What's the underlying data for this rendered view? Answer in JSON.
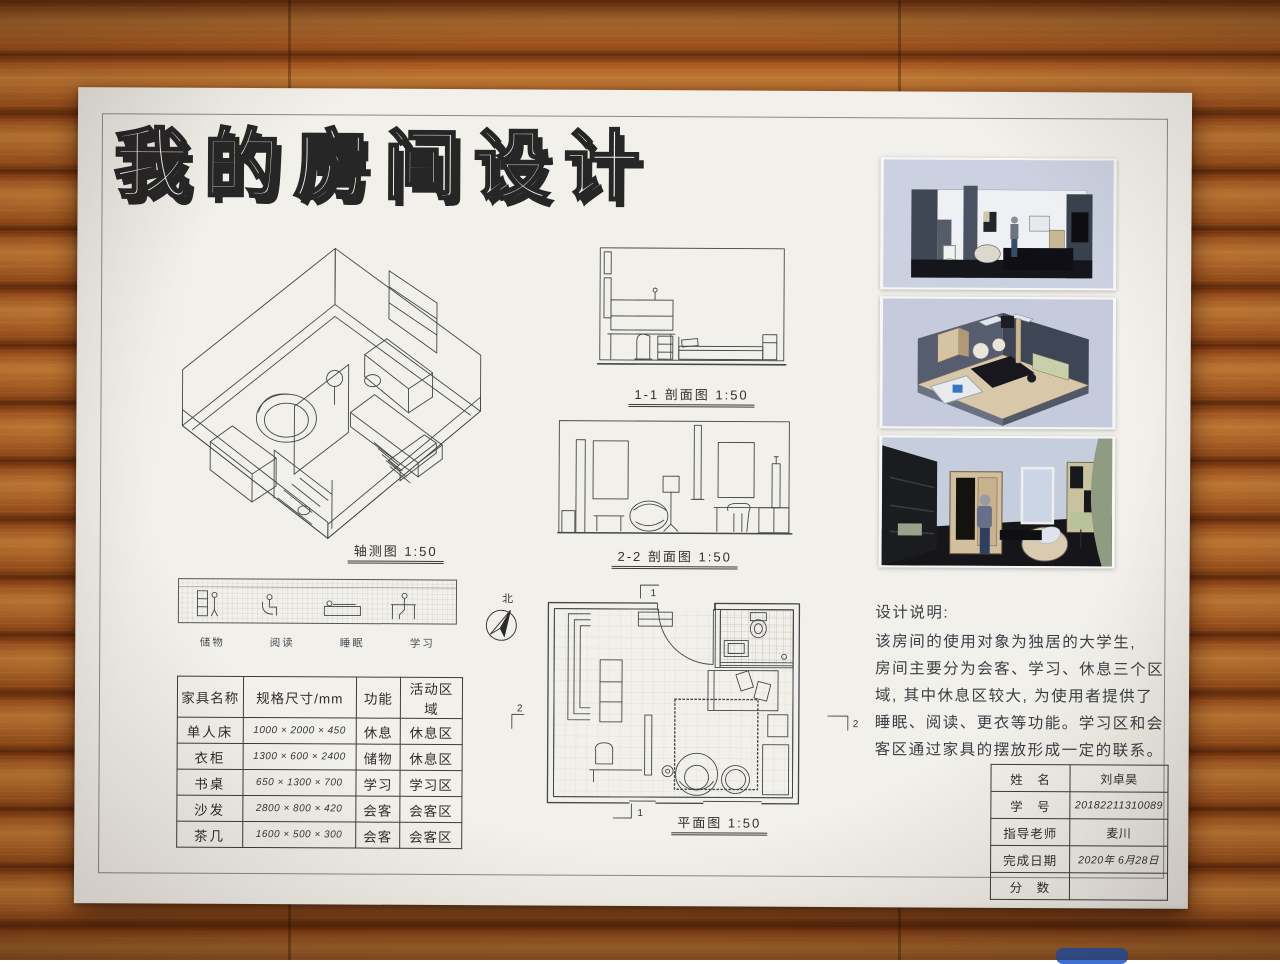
{
  "poster": {
    "title": "我的房间设计",
    "drawings": {
      "axon_caption": "轴测图 1:50",
      "section1_caption": "1-1 剖面图 1:50",
      "section2_caption": "2-2 剖面图 1:50",
      "plan_caption": "平面图 1:50",
      "north_label": "北",
      "marker_1": "1",
      "marker_2": "2",
      "strip_labels": [
        "储物",
        "阅读",
        "睡眠",
        "学习"
      ]
    },
    "furniture_table": {
      "headers": [
        "家具名称",
        "规格尺寸/mm",
        "功能",
        "活动区域"
      ],
      "rows": [
        [
          "单人床",
          "1000 × 2000 × 450",
          "休息",
          "休息区"
        ],
        [
          "衣柜",
          "1300 × 600 × 2400",
          "储物",
          "休息区"
        ],
        [
          "书桌",
          "650 × 1300 × 700",
          "学习",
          "学习区"
        ],
        [
          "沙发",
          "2800 × 800 × 420",
          "会客",
          "会客区"
        ],
        [
          "茶几",
          "1600 × 500 × 300",
          "会客",
          "会客区"
        ]
      ]
    },
    "description": {
      "heading": "设计说明:",
      "lines": [
        "该房间的使用对象为独居的大学生,",
        "房间主要分为会客、学习、休息三个区",
        "域, 其中休息区较大, 为使用者提供了",
        "睡眠、阅读、更衣等功能。学习区和会",
        "客区通过家具的摆放形成一定的联系。"
      ]
    },
    "title_block": {
      "rows": [
        {
          "label": "姓　名",
          "value": "刘卓昊"
        },
        {
          "label": "学　号",
          "value": "20182211310089"
        },
        {
          "label": "指导老师",
          "value": "麦川"
        },
        {
          "label": "完成日期",
          "value": "2020年 6月28日"
        },
        {
          "label": "分　数",
          "value": ""
        }
      ]
    },
    "renders": [
      {
        "name": "section-perspective-render"
      },
      {
        "name": "top-axonometric-render"
      },
      {
        "name": "interior-perspective-render"
      }
    ]
  }
}
